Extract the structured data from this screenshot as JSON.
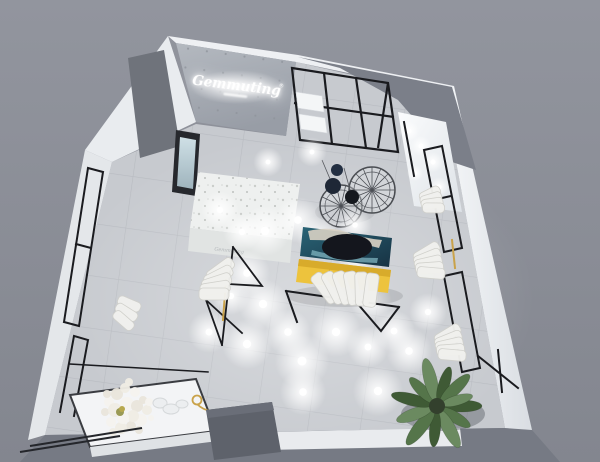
{
  "logo": {
    "text": "Gemmuting",
    "mark": "®"
  },
  "colors": {
    "background_top": "#90939c",
    "background_bottom": "#84holder",
    "background": "#8c8f99",
    "floor": "#c7cacf",
    "tile_line": "#b6b9bf",
    "wall_white": "#eff1f4",
    "concrete_wall": "#adb2b9",
    "ceiling_recess": "#7b7f89",
    "corridor_dark": "#6f737b",
    "frame_black": "#1a1b1f",
    "sofa_yellow": "#edc33d",
    "sofa_shade": "#d8ab2b",
    "art_teal": "#2e6f80",
    "art_dark": "#14161d",
    "art_cream": "#d9d2c4",
    "gold": "#c9a24a",
    "counter_white": "#f3f4f6",
    "storage_box_gray": "#5e626b",
    "garment_white": "#f1f1ee",
    "plant_palette": [
      "#3f5a35",
      "#55754a",
      "#6b8a60"
    ],
    "flower_palette": [
      "#f5f3ee",
      "#e9e5dc",
      "#efece4"
    ]
  },
  "lights": {
    "floor": [
      [
        265,
        231,
        12
      ],
      [
        298,
        220,
        11
      ],
      [
        318,
        237,
        10
      ],
      [
        356,
        258,
        9
      ],
      [
        371,
        301,
        10
      ],
      [
        247,
        273,
        11
      ],
      [
        263,
        304,
        12
      ],
      [
        231,
        296,
        9
      ],
      [
        209,
        332,
        10
      ],
      [
        247,
        344,
        12
      ],
      [
        288,
        332,
        11
      ],
      [
        336,
        332,
        12
      ],
      [
        368,
        347,
        10
      ],
      [
        302,
        361,
        13
      ],
      [
        394,
        331,
        10
      ],
      [
        409,
        351,
        11
      ],
      [
        428,
        312,
        9
      ],
      [
        378,
        391,
        12
      ],
      [
        303,
        392,
        11
      ],
      [
        220,
        210,
        9
      ],
      [
        242,
        232,
        9
      ],
      [
        312,
        152,
        7
      ],
      [
        268,
        162,
        7
      ],
      [
        355,
        225,
        8
      ]
    ],
    "alcove": [
      [
        409,
        131,
        5
      ],
      [
        421,
        146,
        5
      ],
      [
        433,
        162,
        5
      ],
      [
        415,
        173,
        4
      ],
      [
        439,
        187,
        5
      ],
      [
        427,
        202,
        4
      ]
    ]
  },
  "wire_tables": {
    "tables": [
      {
        "cx": 341,
        "cy": 206,
        "r": 21,
        "n": 14
      },
      {
        "cx": 372,
        "cy": 190,
        "r": 23,
        "n": 16
      }
    ],
    "disks": [
      [
        333,
        186,
        8,
        "#1e2736"
      ],
      [
        352,
        197,
        7,
        "#15181e"
      ],
      [
        337,
        170,
        6,
        "#232f42"
      ]
    ]
  },
  "garment_clusters": [
    {
      "x": 334,
      "y": 300,
      "rot": 165,
      "n": 6,
      "w": 13,
      "h": 34,
      "dx": 7,
      "dy": 1
    },
    {
      "x": 231,
      "y": 262,
      "rot": 72,
      "n": 5,
      "w": 12,
      "h": 30,
      "dx": -1,
      "dy": 8
    },
    {
      "x": 437,
      "y": 246,
      "rot": 77,
      "n": 5,
      "w": 11,
      "h": 28,
      "dx": 1.5,
      "dy": 7
    },
    {
      "x": 458,
      "y": 328,
      "rot": 77,
      "n": 5,
      "w": 11,
      "h": 28,
      "dx": 1.5,
      "dy": 7
    },
    {
      "x": 438,
      "y": 190,
      "rot": 77,
      "n": 4,
      "w": 10,
      "h": 22,
      "dx": 1.5,
      "dy": 6
    },
    {
      "x": 120,
      "y": 300,
      "rot": 302,
      "n": 3,
      "w": 10,
      "h": 24,
      "dx": -2,
      "dy": 7
    }
  ],
  "plant": {
    "cx": 437,
    "cy": 406,
    "pot_r": 9,
    "leaves": [
      [
        0,
        40,
        12
      ],
      [
        32,
        34,
        11
      ],
      [
        62,
        42,
        13
      ],
      [
        95,
        36,
        11
      ],
      [
        128,
        44,
        13
      ],
      [
        160,
        38,
        12
      ],
      [
        194,
        42,
        12
      ],
      [
        226,
        34,
        11
      ],
      [
        256,
        44,
        13
      ],
      [
        288,
        36,
        11
      ],
      [
        316,
        40,
        12
      ],
      [
        344,
        32,
        10
      ]
    ]
  },
  "flowers": {
    "cx": 127,
    "cy": 408,
    "petals": [
      [
        -18,
        -6,
        5
      ],
      [
        -10,
        -14,
        6
      ],
      [
        -2,
        -20,
        5
      ],
      [
        8,
        -16,
        5
      ],
      [
        16,
        -8,
        4
      ],
      [
        20,
        2,
        5
      ],
      [
        14,
        12,
        6
      ],
      [
        4,
        18,
        5
      ],
      [
        -6,
        20,
        6
      ],
      [
        -16,
        14,
        5
      ],
      [
        -22,
        4,
        4
      ],
      [
        -12,
        2,
        7
      ],
      [
        0,
        -4,
        7
      ],
      [
        10,
        -2,
        6
      ],
      [
        6,
        8,
        6
      ],
      [
        -4,
        10,
        6
      ],
      [
        -20,
        -14,
        4
      ],
      [
        2,
        -26,
        4
      ],
      [
        22,
        -6,
        4
      ],
      [
        12,
        22,
        4
      ],
      [
        -14,
        24,
        4
      ],
      [
        24,
        10,
        3
      ]
    ]
  }
}
